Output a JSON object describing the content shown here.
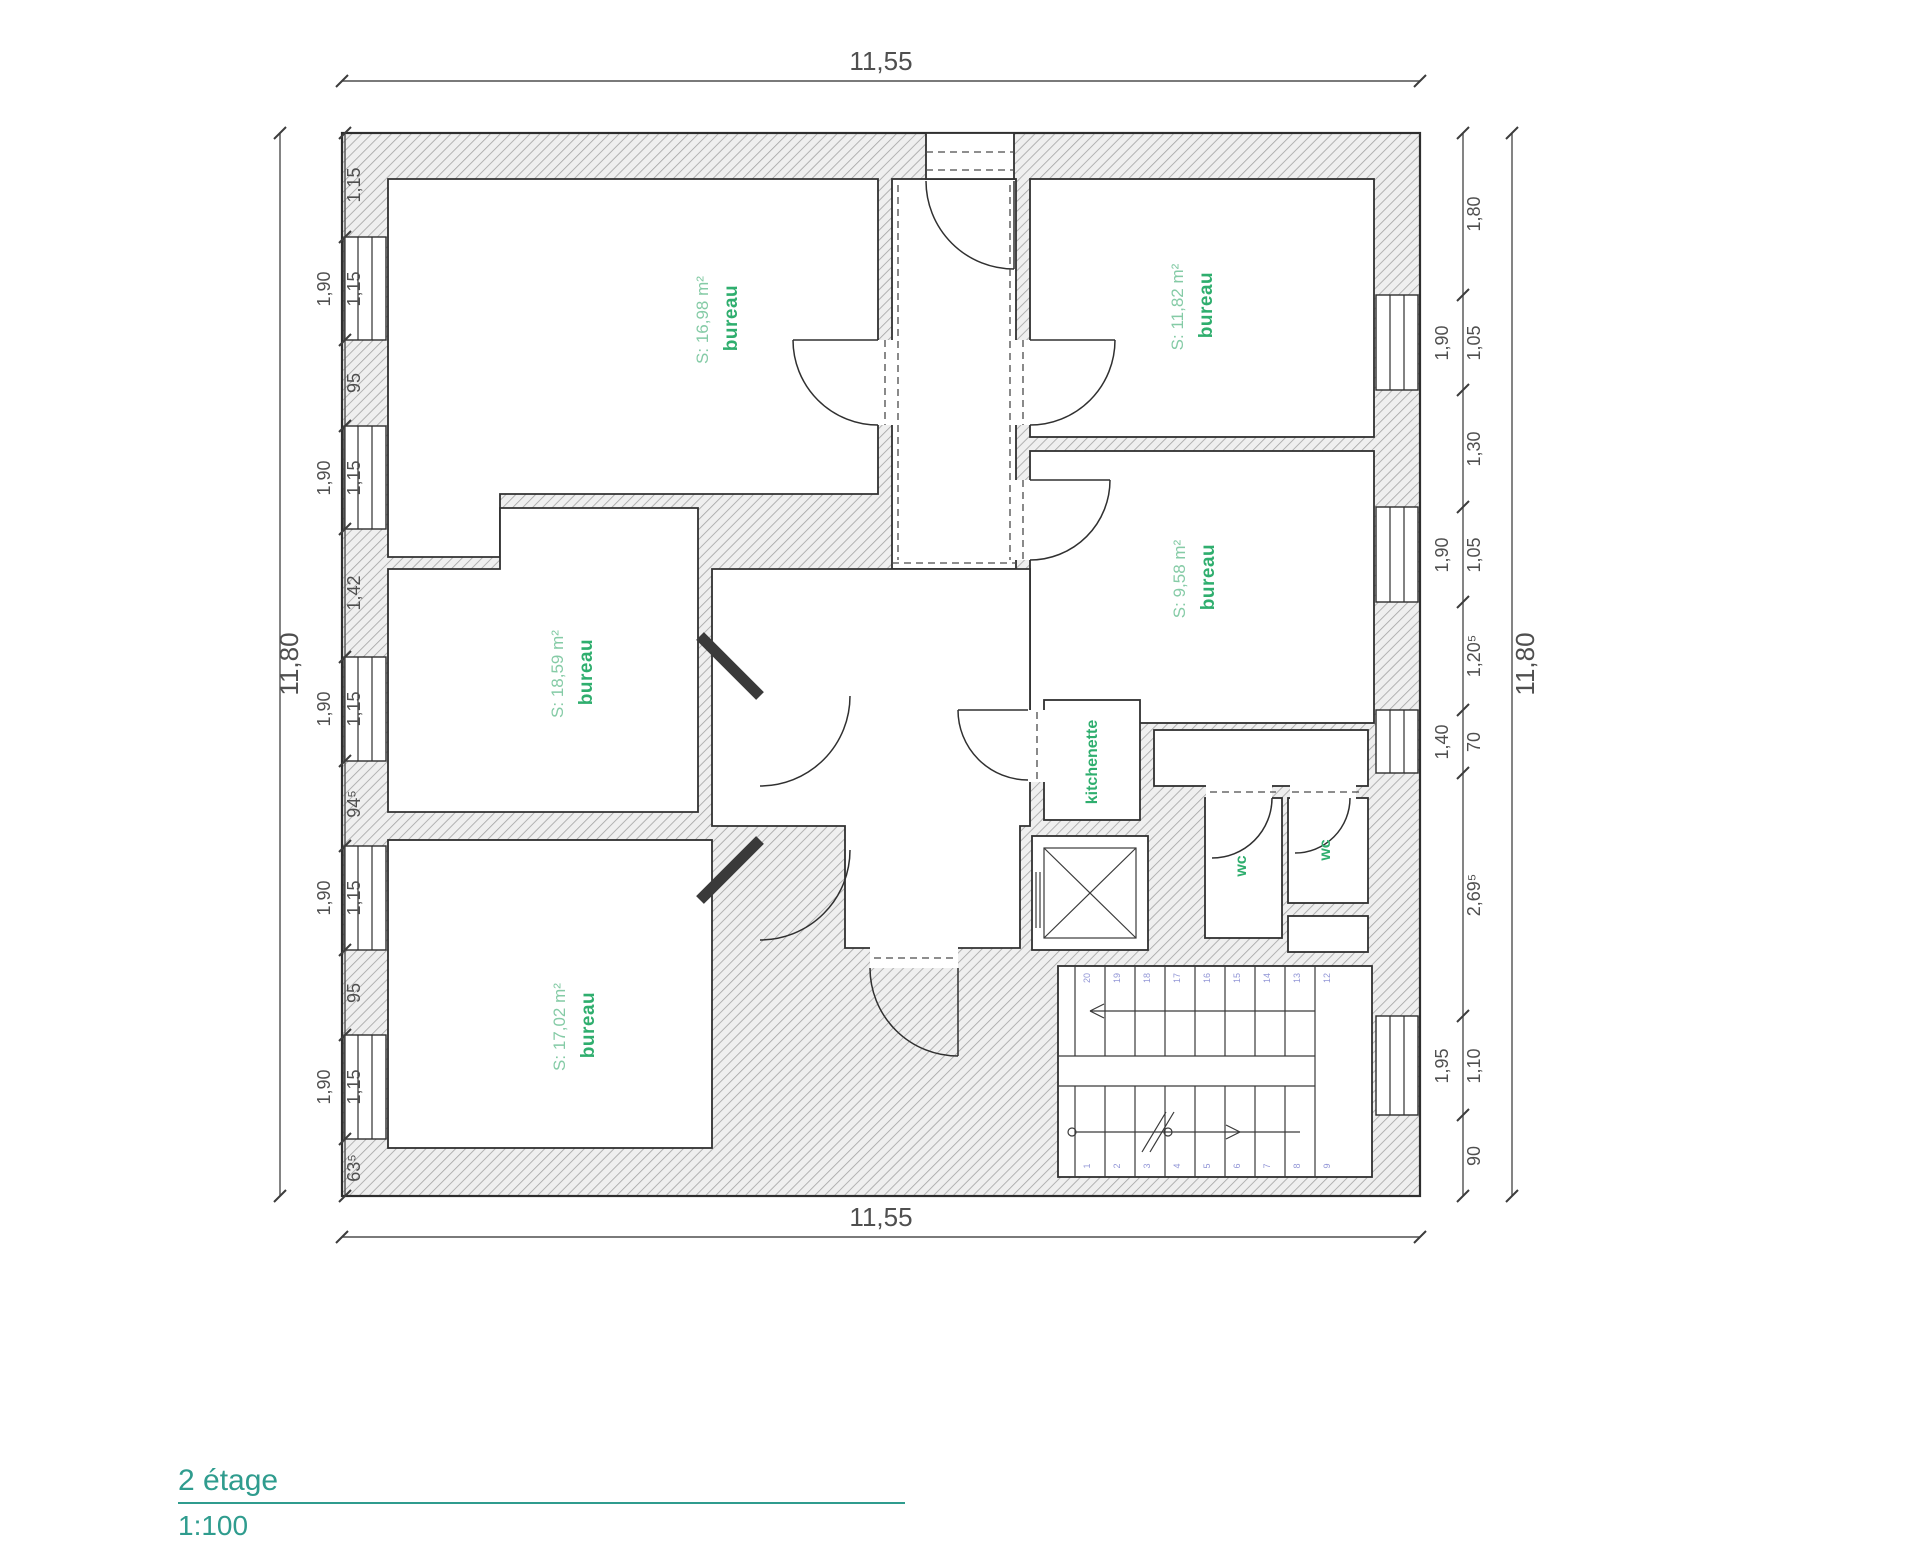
{
  "title": {
    "floor": "2 étage",
    "scale": "1:100"
  },
  "colors": {
    "room_label_green": "#2fae6e",
    "room_area_green": "#85cba6",
    "title_teal": "#2f9c8e",
    "stair_number_blue": "#9296d6",
    "dimension_gray": "#4f4f4f"
  },
  "rooms": [
    {
      "id": "bureau-top-left",
      "name": "bureau",
      "area": "S: 16,98 m²"
    },
    {
      "id": "bureau-top-right",
      "name": "bureau",
      "area": "S: 11,82 m²"
    },
    {
      "id": "bureau-mid-right",
      "name": "bureau",
      "area": "S: 9,58 m²"
    },
    {
      "id": "bureau-mid-left",
      "name": "bureau",
      "area": "S: 18,59 m²"
    },
    {
      "id": "bureau-bottom-left",
      "name": "bureau",
      "area": "S: 17,02 m²"
    },
    {
      "id": "kitchenette",
      "name": "kitchenette"
    },
    {
      "id": "wc-left",
      "name": "wc"
    },
    {
      "id": "wc-right",
      "name": "wc"
    }
  ],
  "dims": {
    "top": "11,55",
    "bottom": "11,55",
    "left_total": "11,80",
    "right_total": "11,80",
    "left_chain": [
      {
        "v": "1,15"
      },
      {
        "v": "1,15",
        "w": "1,90"
      },
      {
        "v": "95"
      },
      {
        "v": "1,15",
        "w": "1,90"
      },
      {
        "v": "1,42"
      },
      {
        "v": "1,15",
        "w": "1,90"
      },
      {
        "v": "94⁵"
      },
      {
        "v": "1,15",
        "w": "1,90"
      },
      {
        "v": "95"
      },
      {
        "v": "1,15",
        "w": "1,90"
      },
      {
        "v": "63⁵"
      }
    ],
    "right_chain": [
      {
        "v": "1,80"
      },
      {
        "v": "1,05",
        "w": "1,90"
      },
      {
        "v": "1,30"
      },
      {
        "v": "1,05",
        "w": "1,90"
      },
      {
        "v": "1,20⁵"
      },
      {
        "v": "70",
        "w": "1,40"
      },
      {
        "v": "2,69⁵"
      },
      {
        "v": "1,10",
        "w": "1,95"
      },
      {
        "v": "90"
      }
    ]
  },
  "stairs": {
    "upper": [
      "20",
      "19",
      "18",
      "17",
      "16",
      "15",
      "14",
      "13",
      "12"
    ],
    "lower": [
      "1",
      "2",
      "3",
      "4",
      "5",
      "6",
      "7",
      "8",
      "9"
    ]
  }
}
